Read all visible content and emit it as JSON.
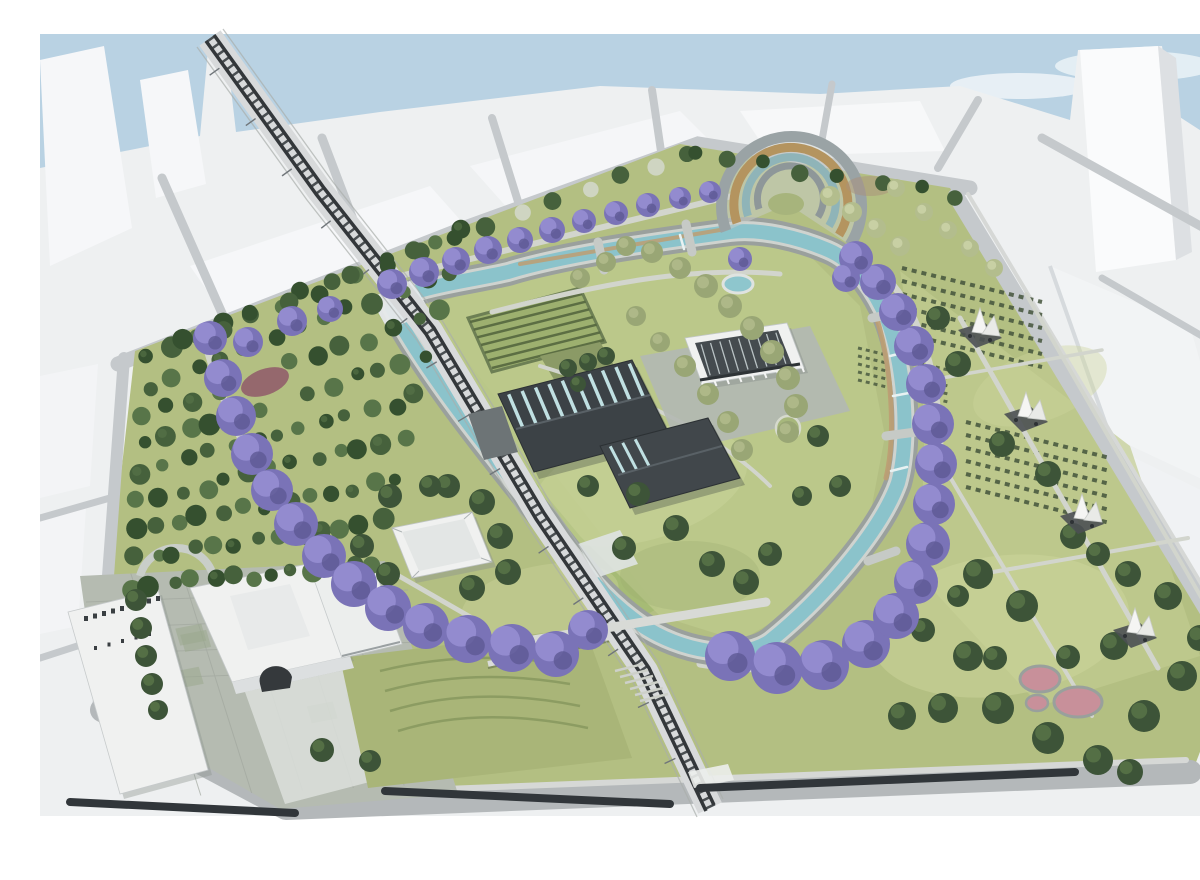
{
  "meta": {
    "title": "Urban park masterplan aerial rendering",
    "description": "Aerial architectural rendering of an urban park masterplan: a looping canal and a railway cross tree-filled grounds ringed by purple jacarandas, with white city massing blocks around the edges."
  },
  "palette": {
    "sky": "#b9d2e3",
    "cloud": "#eef5f8",
    "city": "#eef0f1",
    "city_face": "#f6f7f9",
    "city_shadow": "#dde0e3",
    "street": "#c5c9cc",
    "street_dark": "#b4b8ba",
    "park_green": "#b3bf82",
    "meadow_light": "#cdd59b",
    "meadow_dark": "#9dac6f",
    "corridor_green": "#a3ba72",
    "forest_dark": "#35502f",
    "forest_mid": "#46613c",
    "forest_light": "#587549",
    "blossom": "#cfd5c2",
    "tree_green": "#3d5438",
    "tree_light": "#5c784a",
    "olive": "#99a675",
    "olive_light": "#b3bd8d",
    "jacaranda": "#7a73b7",
    "jacaranda_light": "#968ed2",
    "jacaranda_dark": "#5e5994",
    "canal_edge": "#9aa09d",
    "canal_concrete": "#cfd3cf",
    "canal_water": "#8bc3cb",
    "boardwalk": "#bd9d72",
    "rail_bed": "#d8dadb",
    "rail_dark": "#33373a",
    "rail_tie": "#4a4f52",
    "roof_dark": "#3c4246",
    "roof_ridge": "#596166",
    "skylight": "#c0e0e2",
    "white_bldg": "#f0f1f0",
    "plaza": "#b5bbb1",
    "plaza_line": "#a2a89f",
    "wood": "#b4945f",
    "glass_teal": "#8fb4b8",
    "concrete": "#9aa3a5",
    "path": "#d2d5cd",
    "pergola": "#31363a",
    "sail": "#f5f5f3",
    "sail_base": "#4b5053",
    "pond": "#8ec6cd",
    "pink": "#c8909a",
    "clay": "#93636b",
    "crop_row": "#55673f"
  },
  "scene": {
    "features": [
      "sky with clouds",
      "white city massing blocks",
      "street grid",
      "railway line crossing the park",
      "looping canal watercourse",
      "curved amphitheater terraces",
      "rows of purple jacaranda trees",
      "dense conifer forest",
      "community garden rows",
      "industrial sheds with skylight roofs",
      "white colonnaded hall",
      "garden pavilion",
      "historic arched building and plaza",
      "white sail-canopy pavilions",
      "oval pond",
      "round pink play courts",
      "terraced contour meadow",
      "lawns with winding paths",
      "pedestrian bridges over canal and rail",
      "street pergolas"
    ]
  }
}
